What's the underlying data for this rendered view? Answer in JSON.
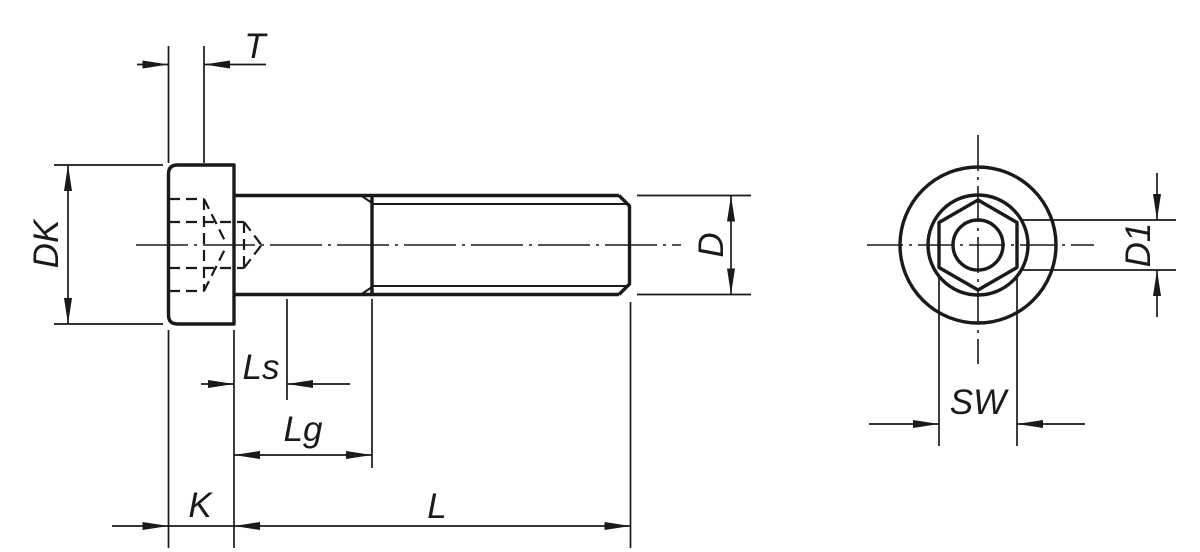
{
  "drawing": {
    "background_color": "#ffffff",
    "line_color": "#1a1a1a",
    "side_view": {
      "labels": {
        "socket_depth": "T",
        "head_diameter": "DK",
        "shank_length": "Ls",
        "grip_length": "Lg",
        "head_height": "K",
        "screw_length": "L",
        "thread_diameter": "D"
      }
    },
    "end_view": {
      "labels": {
        "socket_width_across_flats": "SW",
        "core_hole_diameter": "D1"
      }
    }
  }
}
